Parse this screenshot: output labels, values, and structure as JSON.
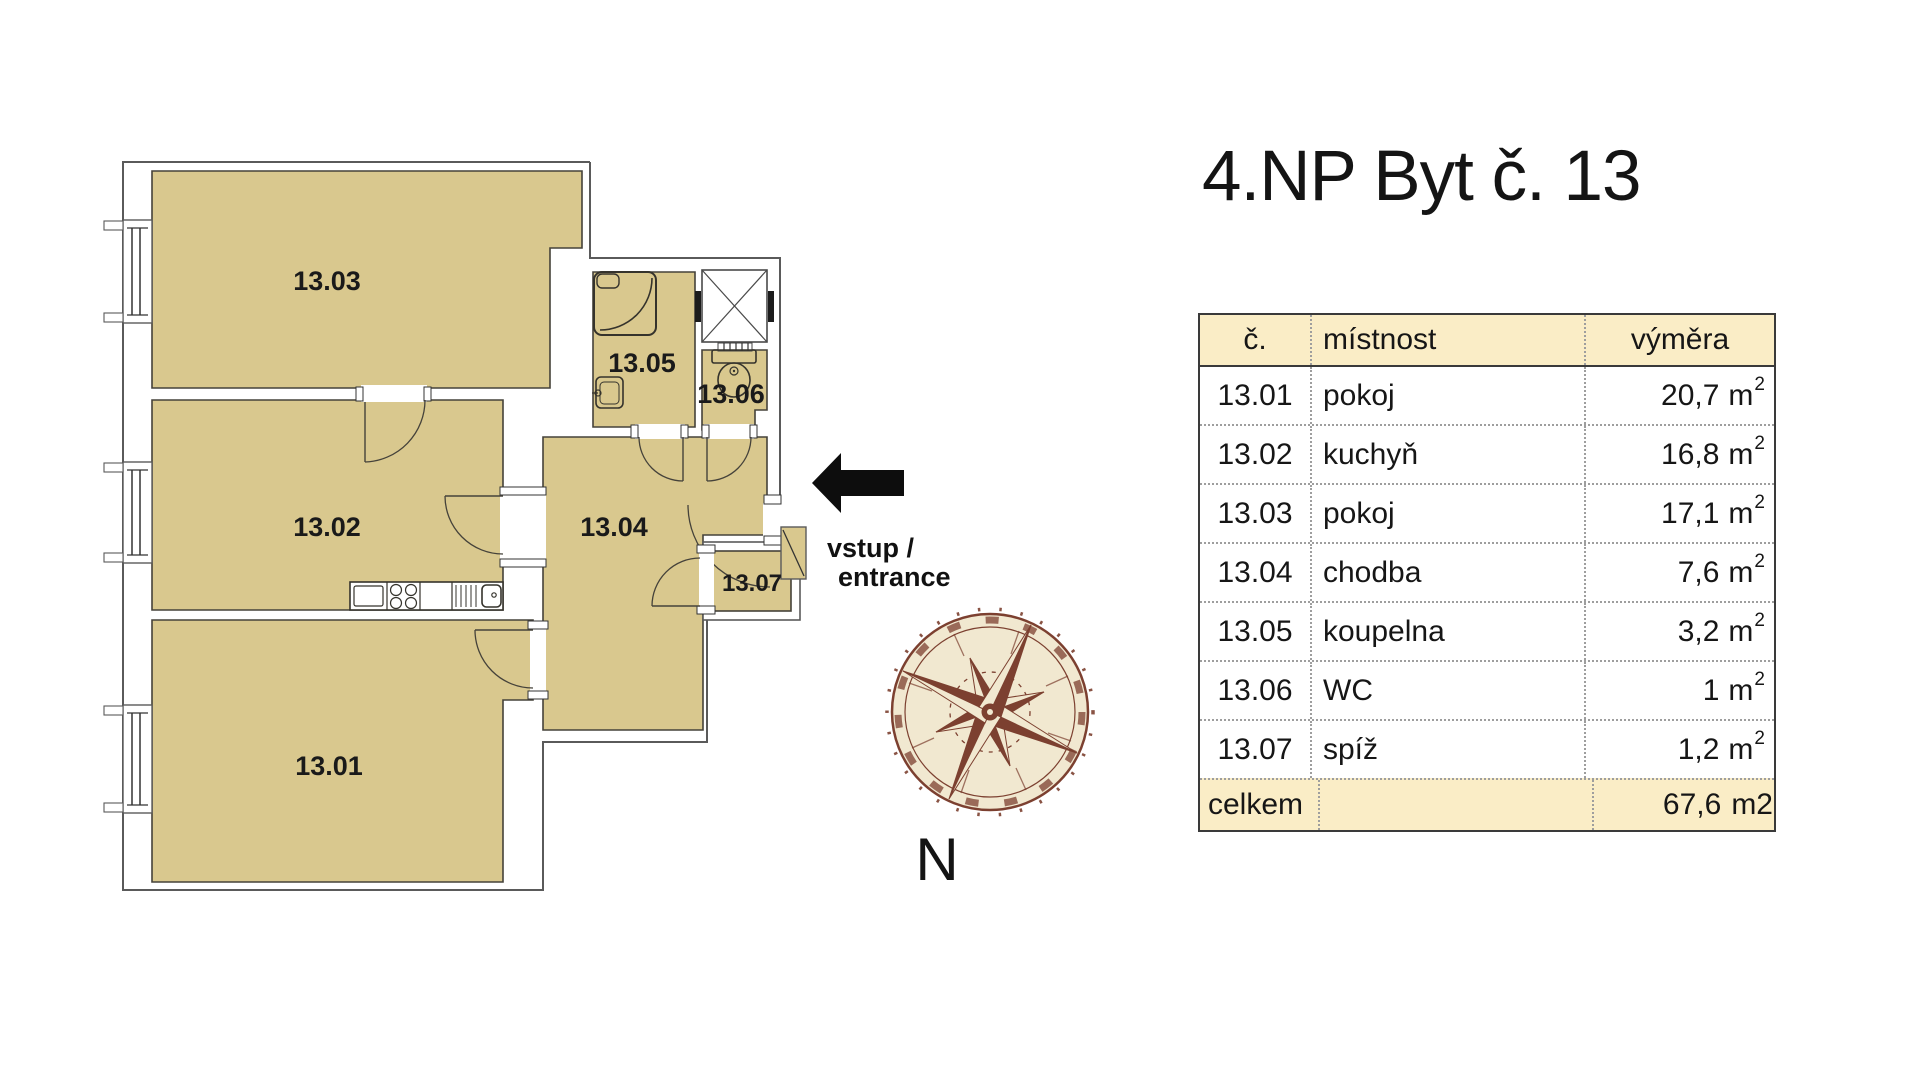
{
  "title": "4.NP Byt č. 13",
  "plan": {
    "rooms": [
      {
        "id": "13.01",
        "name": "pokoj"
      },
      {
        "id": "13.02",
        "name": "kuchyň"
      },
      {
        "id": "13.03",
        "name": "pokoj"
      },
      {
        "id": "13.04",
        "name": "chodba"
      },
      {
        "id": "13.05",
        "name": "koupelna"
      },
      {
        "id": "13.06",
        "name": "WC"
      },
      {
        "id": "13.07",
        "name": "spíž"
      }
    ],
    "entrance": {
      "line1": "vstup /",
      "line2": "entrance"
    },
    "compass": {
      "north_label": "N"
    }
  },
  "table": {
    "headers": {
      "number": "č.",
      "room": "místnost",
      "area": "výměra"
    },
    "unit": {
      "base": "m",
      "sup": "2"
    },
    "rows": [
      {
        "number": "13.01",
        "room": "pokoj",
        "area": "20,7"
      },
      {
        "number": "13.02",
        "room": "kuchyň",
        "area": "16,8"
      },
      {
        "number": "13.03",
        "room": "pokoj",
        "area": "17,1"
      },
      {
        "number": "13.04",
        "room": "chodba",
        "area": "7,6"
      },
      {
        "number": "13.05",
        "room": "koupelna",
        "area": "3,2"
      },
      {
        "number": "13.06",
        "room": "WC",
        "area": "1"
      },
      {
        "number": "13.07",
        "room": "spíž",
        "area": "1,2"
      }
    ],
    "footer": {
      "label": "celkem",
      "area": "67,6",
      "unit": "m2"
    }
  },
  "colors": {
    "room_fill": "#d9c88e",
    "wall_line": "#5a5a5a",
    "table_header_bg": "#faedc6",
    "compass_brown": "#7c4030",
    "compass_cream": "#f1e8d0",
    "arrow_black": "#0d0d0d"
  }
}
